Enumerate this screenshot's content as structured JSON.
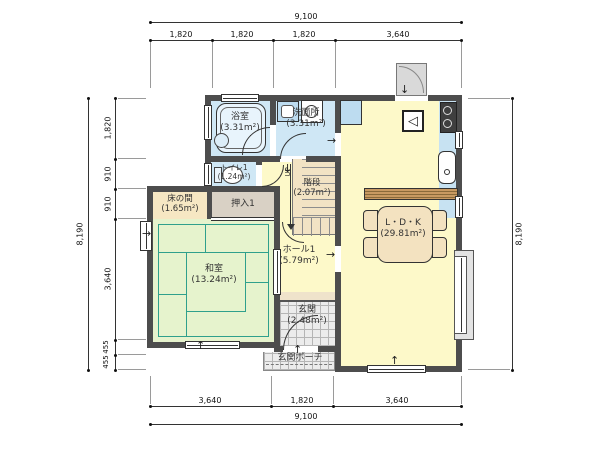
{
  "rooms": {
    "bathroom": {
      "name": "浴室",
      "area": "(3.31m²)"
    },
    "washroom": {
      "name": "洗面所",
      "area": "(3.31m²)"
    },
    "toilet": {
      "name": "トイレ1",
      "area": "(1.24m²)"
    },
    "tokonoma": {
      "name": "床の間",
      "area": "(1.65m²)"
    },
    "closet": {
      "name": "押入1"
    },
    "washitsu": {
      "name": "和室",
      "area": "(13.24m²)"
    },
    "stairs": {
      "name": "階段",
      "area": "(2.07m²)",
      "direction": "UP"
    },
    "hall": {
      "name": "ホール1",
      "area": "(5.79m²)"
    },
    "ldk": {
      "name": "L・D・K",
      "area": "(29.81m²)"
    },
    "entrance": {
      "name": "玄関",
      "area": "(2.48m²)"
    },
    "porch": {
      "name": "玄関ポーチ"
    }
  },
  "dimensions": {
    "top": {
      "total": "9,100",
      "segments": [
        "1,820",
        "1,820",
        "1,820",
        "3,640"
      ]
    },
    "bottom": {
      "total": "9,100",
      "segments": [
        "3,640",
        "1,820",
        "3,640"
      ]
    },
    "left": {
      "total": "8,190",
      "segments": [
        "1,820",
        "910",
        "910",
        "3,640",
        "455",
        "455"
      ]
    },
    "right": {
      "total": "8,190"
    }
  },
  "icons": {
    "arrow_up": "↑",
    "arrow_down": "↓",
    "arrow_right": "→",
    "fridge_triangle": "◁"
  },
  "colors": {
    "wall": "#4d4d4d",
    "ldk_floor": "#fdf9c9",
    "wet_floor": "#cfe7f5",
    "tatami": "#e6f3cd",
    "tatami_line": "#2fa08c",
    "tokonoma_floor": "#f6e7c3",
    "closet_floor": "#d9d1c5",
    "stairs_floor": "#f2e3c4",
    "tile": "#ececec",
    "counter": "#c89a62",
    "furniture": "#f3e2c0",
    "appliance_blue": "#bddcf0"
  }
}
